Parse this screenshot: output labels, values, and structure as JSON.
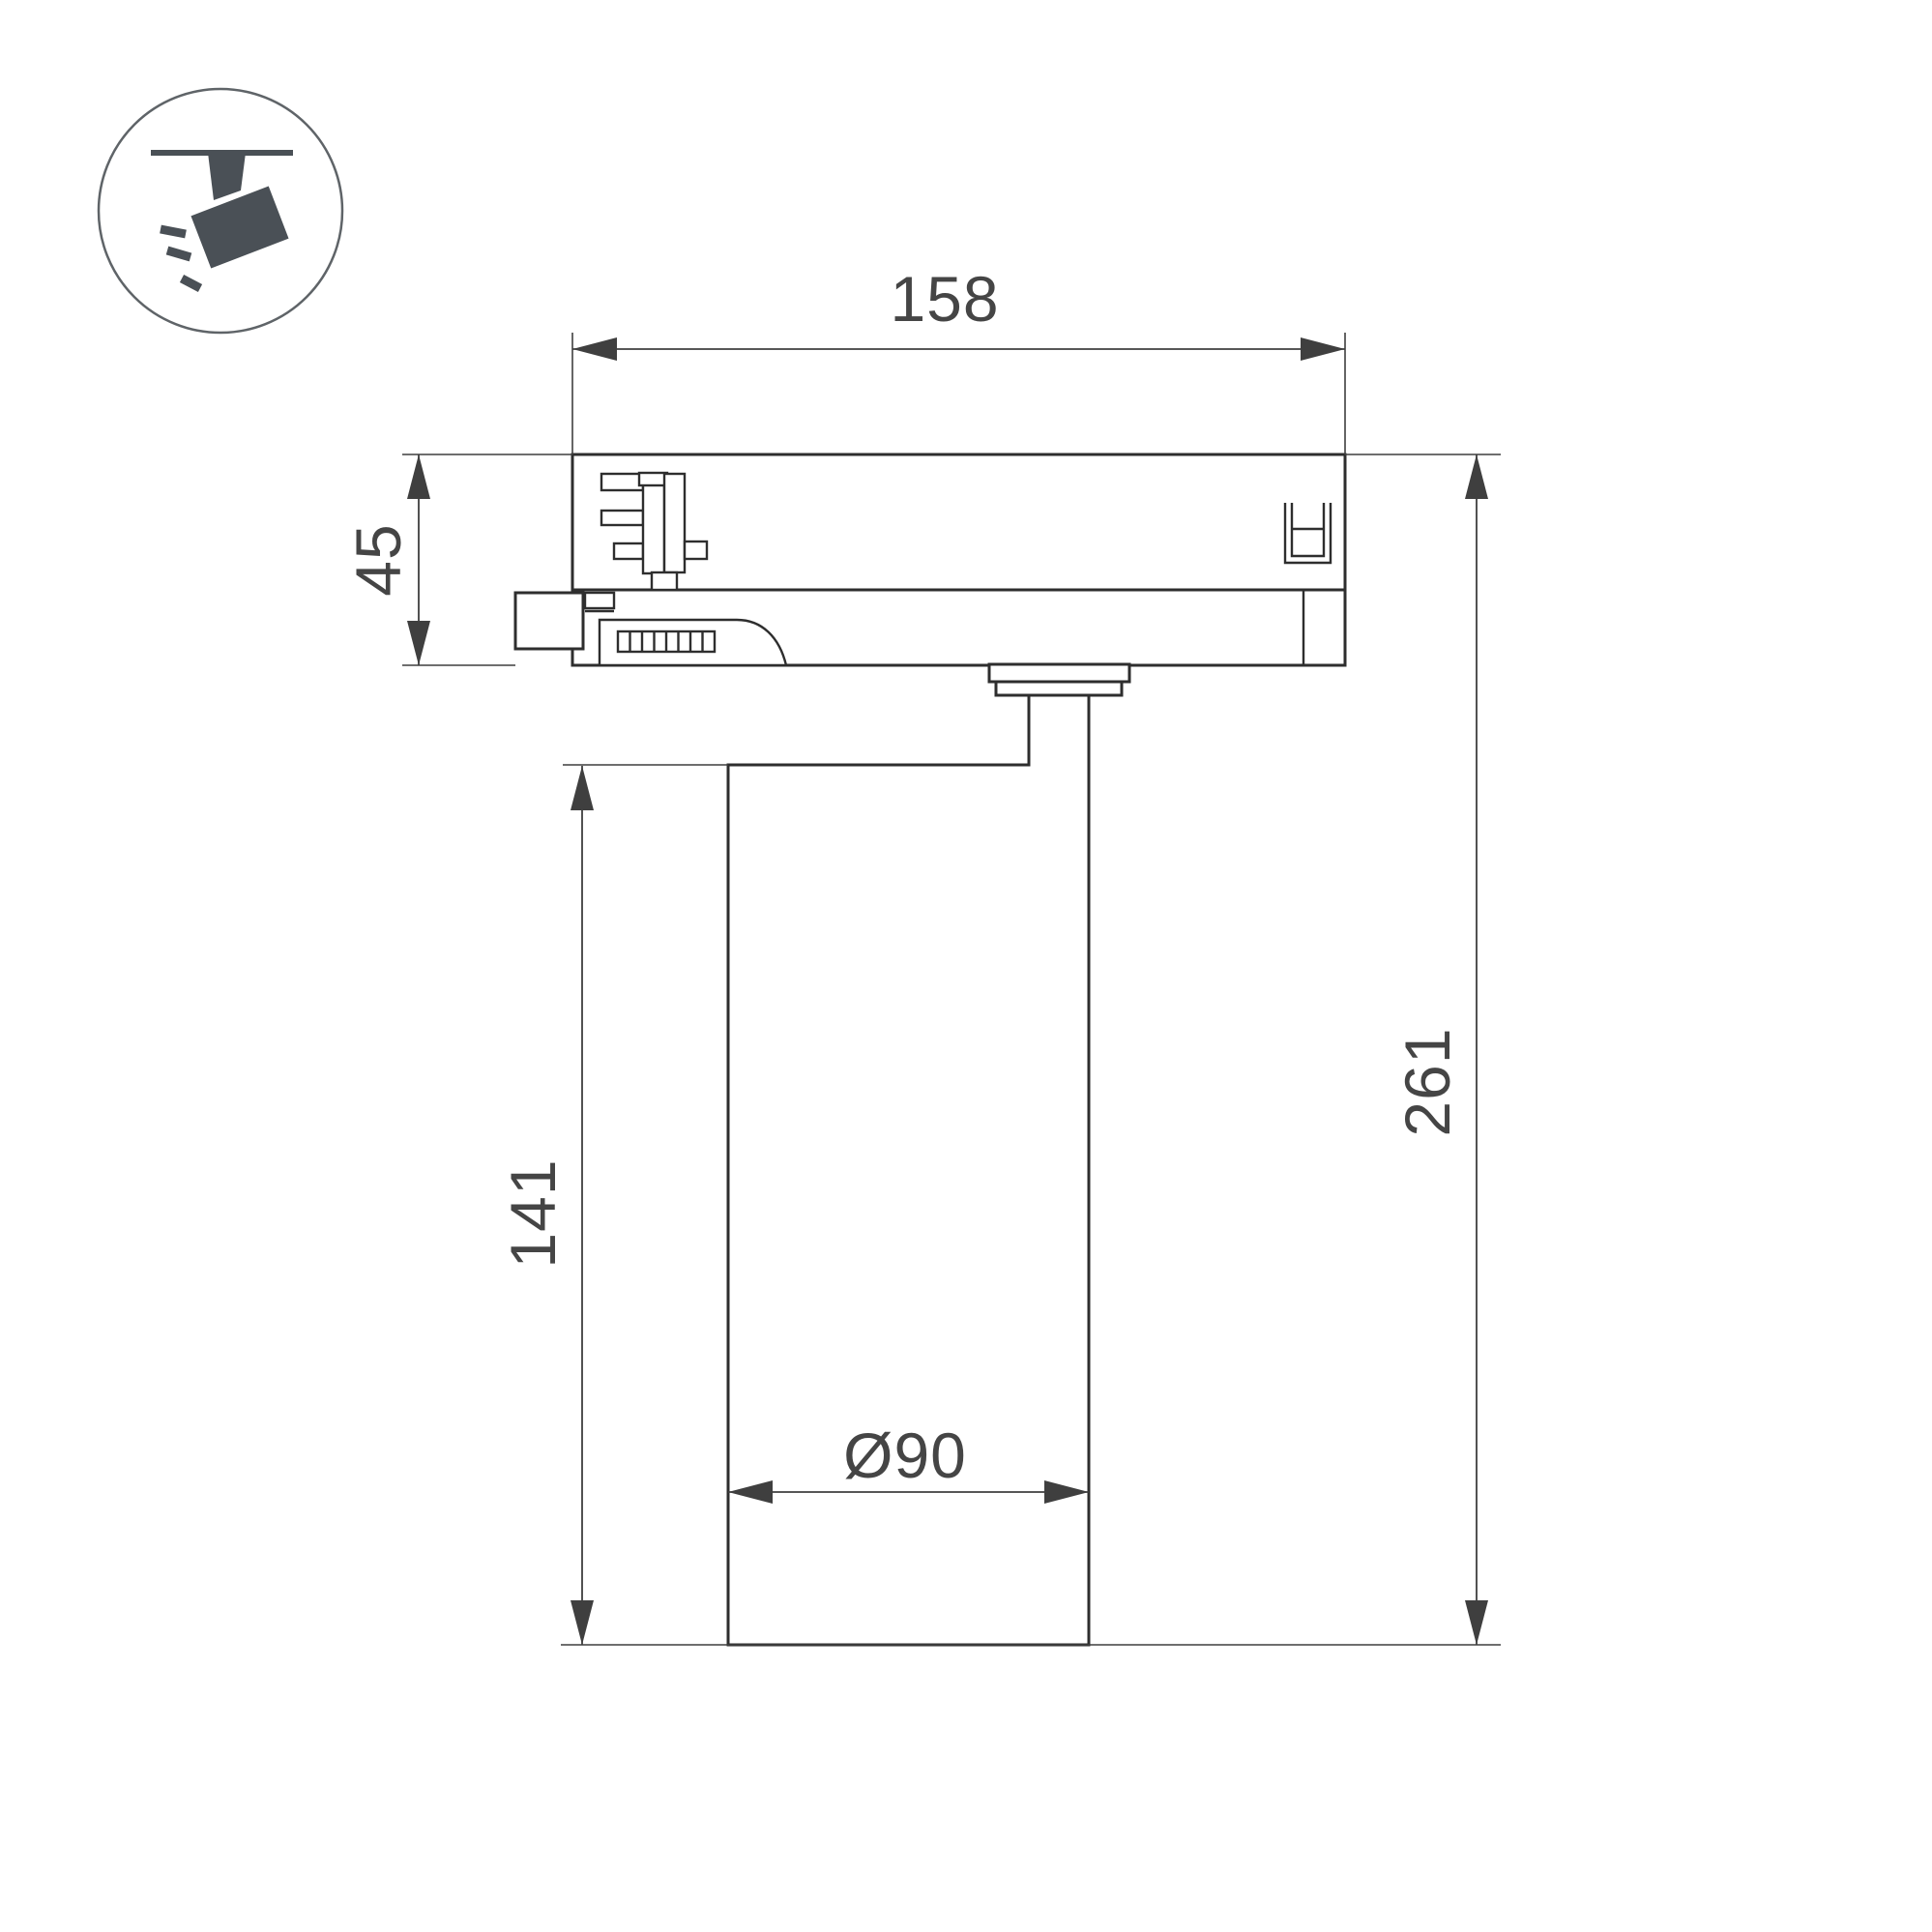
{
  "drawing": {
    "kind": "technical-dimension-drawing",
    "subject": "3-phase track spotlight, side view with track adapter",
    "background": "#ffffff",
    "part_line_color": "#2e2e2e",
    "dimension_line_color": "#3f3f3f",
    "text_color": "#454545"
  },
  "legend_icon": {
    "name": "track-spotlight-pictogram",
    "glyph_color": "#4a5056",
    "ring_color": "#5f6468"
  },
  "dimensions": {
    "adapter_width_mm": "158",
    "adapter_height_mm": "45",
    "body_height_mm": "141",
    "overall_height_mm": "261",
    "body_diameter_mm": "Ø90"
  }
}
